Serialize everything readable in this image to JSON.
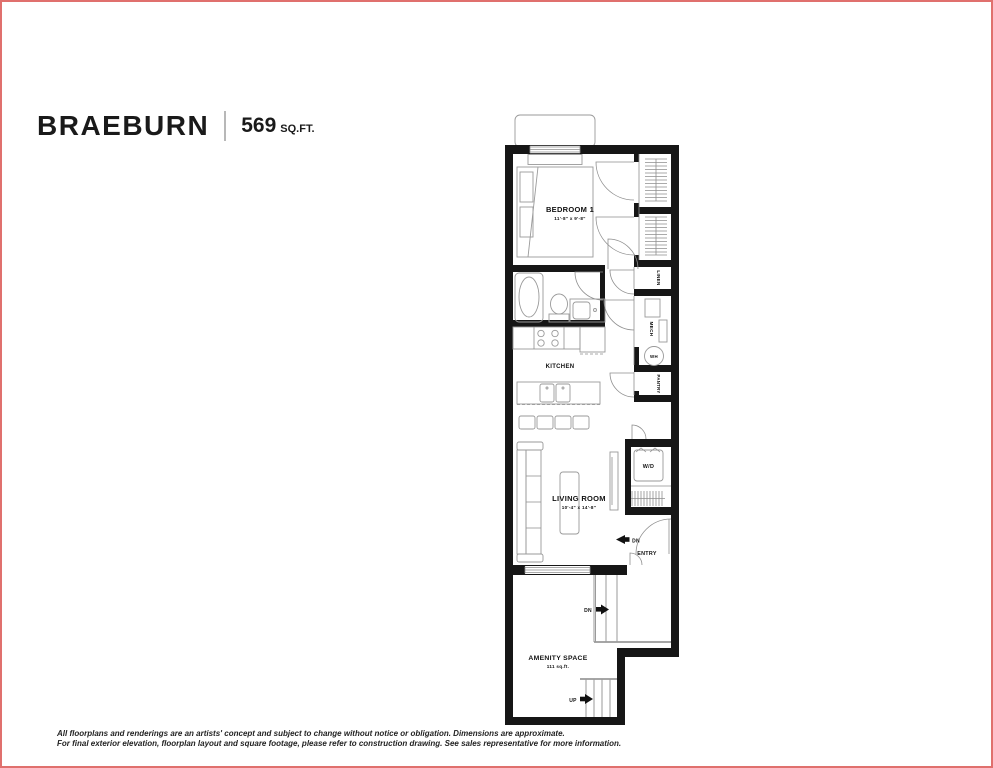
{
  "colors": {
    "border": "#e0706d",
    "wall": "#161616",
    "fixture_line": "#9a9a9a",
    "text": "#111111"
  },
  "header": {
    "plan_name": "BRAEBURN",
    "area_value": "569",
    "area_unit": "SQ.FT."
  },
  "plan": {
    "bedroom": {
      "name": "BEDROOM 1",
      "dims": "11'-8\" x 9'-8\""
    },
    "kitchen": {
      "name": "KITCHEN"
    },
    "living": {
      "name": "LIVING ROOM",
      "dims": "10'-4\" x 14'-8\""
    },
    "amenity": {
      "name": "AMENITY SPACE",
      "area": "111 sq.ft."
    },
    "labels": {
      "linen": "LINEN",
      "mech": "MECH",
      "wh": "WH",
      "pantry": "PANTRY",
      "wd": "W/D",
      "entry": "ENTRY",
      "dn": "DN",
      "up": "UP"
    }
  },
  "footer": {
    "line1": "All floorplans and renderings are an artists' concept and subject to change without notice or obligation. Dimensions are approximate.",
    "line2": "For final exterior elevation, floorplan layout and square footage, please refer to construction drawing. See sales representative for more information."
  }
}
